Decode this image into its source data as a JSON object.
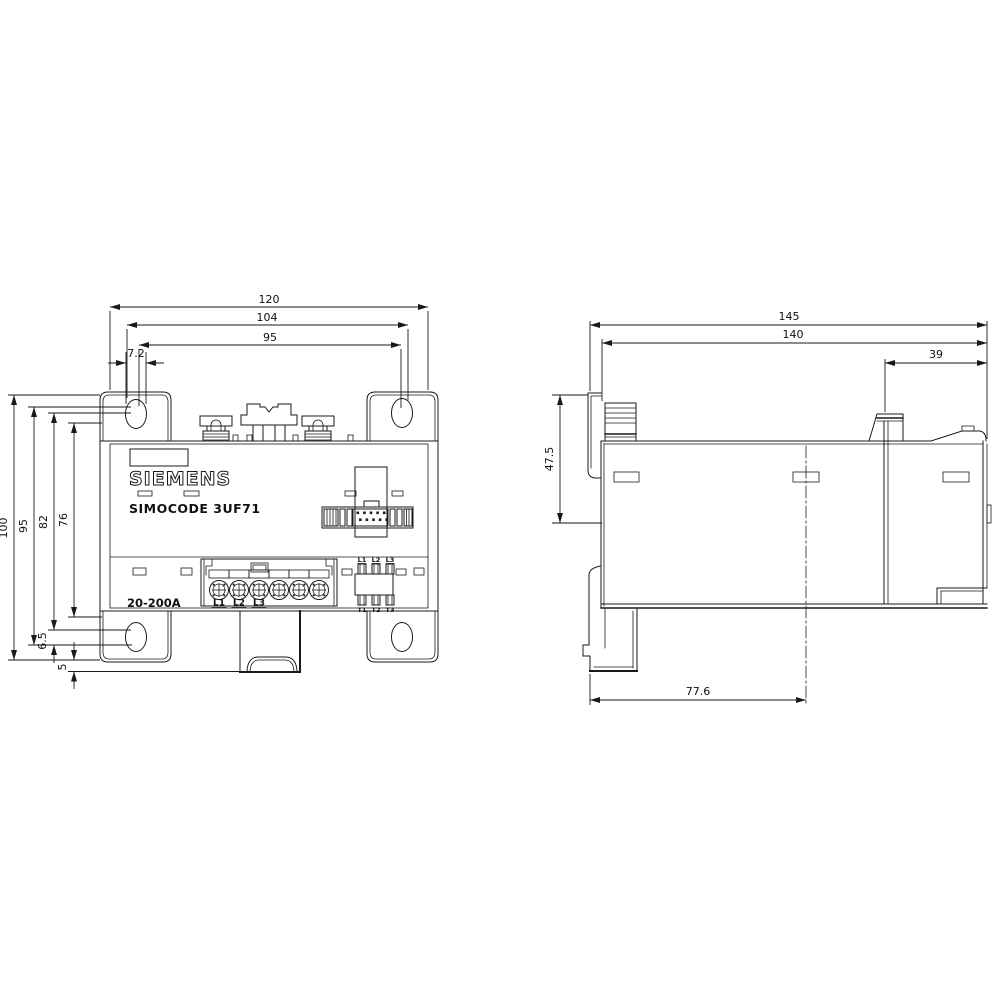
{
  "drawing": {
    "front": {
      "brand": "SIEMENS",
      "model": "SIMOCODE 3UF71",
      "current_range": "20-200A",
      "dims": {
        "w120": "120",
        "w104": "104",
        "w95": "95",
        "w7_2": "7.2",
        "h100": "100",
        "h95": "95",
        "h82": "82",
        "h76": "76",
        "h6_5": "6.5",
        "h5": "5"
      },
      "terminals": [
        "L1",
        "L2",
        "L3"
      ],
      "aux_top": [
        "L1",
        "L2",
        "L3"
      ],
      "aux_bottom": [
        "T1",
        "T2",
        "T3"
      ]
    },
    "side": {
      "dims": {
        "d145": "145",
        "d140": "140",
        "d39": "39",
        "d47_5": "47.5",
        "d77_6": "77.6"
      }
    }
  }
}
